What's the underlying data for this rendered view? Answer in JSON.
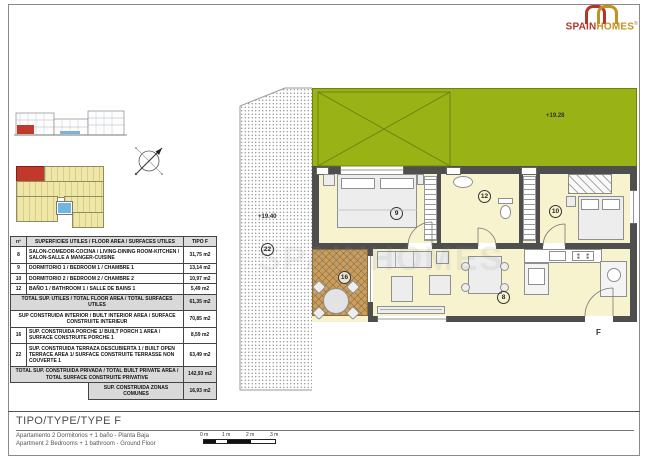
{
  "logo": {
    "brand_red": "SPAIN",
    "brand_gold": "HOMES",
    "reg": "®"
  },
  "colors": {
    "brand_red": "#b5342c",
    "brand_gold": "#c39021",
    "plan_green": "#99b317",
    "room_cream": "#f7f3cf",
    "porch_tan": "#c89e61",
    "highlight_red": "#c0392b"
  },
  "plan": {
    "levels": {
      "terrace_upper": "+19.28",
      "terrace_lower": "+19.40"
    },
    "rooms": {
      "living": "8",
      "bed1": "9",
      "bed2": "10",
      "bath": "12",
      "porch": "16",
      "terrace": "22"
    },
    "unit_label": "F",
    "watermark": "SPAINHOMES"
  },
  "table": {
    "header": {
      "num": "nº",
      "desc": "SUPERFICIES UTILES / FLOOR AREA / SURFACES UTILES",
      "type": "TIPO F"
    },
    "rows": [
      {
        "num": "8",
        "desc": "SALON-COMEDOR-COCINA /  LIVING-DINING ROOM-KITCHEN / SALON-SALLE A MANGER-CUISINE",
        "value": "31,75 m2"
      },
      {
        "num": "9",
        "desc": "DORMITORIO 1 / BEDROOM 1 / CHAMBRE 1",
        "value": "13,14 m2"
      },
      {
        "num": "10",
        "desc": "DORMITORIO 2 / BEDROOM 2 / CHAMBRE 2",
        "value": "10,97 m2"
      },
      {
        "num": "12",
        "desc": "BAÑO 1 / BATHROOM 1 / SALLE DE BAINS 1",
        "value": "5,49 m2"
      },
      {
        "desc": "TOTAL SUP. UTILES / TOTAL FLOOR AREA / TOTAL SURFACES UTILES",
        "value": "61,35 m2"
      },
      {
        "desc": "SUP CONSTRUIDA INTERIOR / BUILT INTERIOR AREA  / SURFACE CONSTRUITE INTERIEUR",
        "value": "70,85 m2"
      },
      {
        "num": "16",
        "desc": "SUP. CONSTRUIDA PORCHE 1/ BUILT PORCH 1 AREA / SURFACE CONSTRUITE PORCHE 1",
        "value": "8,59 m2"
      },
      {
        "num": "22",
        "desc": "SUP. CONSTRUIDA TERRAZA DESCUBIERTA 1 / BUILT OPEN TERRACE AREA 1/  SURFACE CONSTRUITE TERRASSE NON COUVERTE 1",
        "value": "63,49 m2"
      },
      {
        "desc": "TOTAL SUP. CONSTRUIDA PRIVADA / TOTAL  BUILT PRIVATE AREA / TOTAL SURFACE CONSTRUITE PRIVATIVE",
        "value": "142,93 m2"
      },
      {
        "desc": "SUP. CONSTRUIDA ZONAS COMUNES",
        "value": "16,93 m2"
      }
    ]
  },
  "footer": {
    "title": "TIPO/TYPE/TYPE F",
    "line1": "Apartamento 2 Dormitorios + 1 baño - Planta Baja",
    "line2": "Apartment 2 Bedrooms + 1 bathroom - Ground Floor",
    "scale": {
      "labels": [
        "0 m",
        "1 m",
        "2 m",
        "3 m"
      ]
    }
  }
}
